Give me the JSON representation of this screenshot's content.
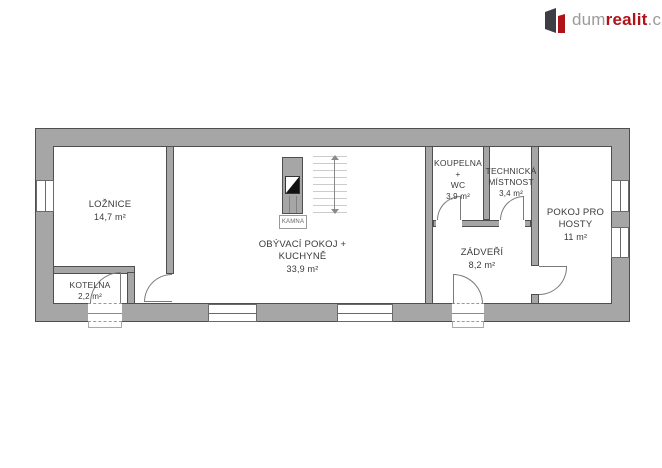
{
  "logo": {
    "prefix": "dum",
    "highlight": "realit",
    "suffix": ".cz"
  },
  "rooms": {
    "loznice": {
      "name": "LOŽNICE",
      "area": "14,7 m²"
    },
    "kotelna": {
      "name": "KOTELNA",
      "area": "2,2 m²"
    },
    "obyvaci": {
      "line1": "OBÝVACÍ POKOJ +",
      "line2": "KUCHYNĚ",
      "area": "33,9 m²"
    },
    "koupelna": {
      "line1": "KOUPELNA",
      "line2": "+",
      "line3": "WC",
      "area": "3,9 m²"
    },
    "technicka": {
      "line1": "TECHNICKÁ",
      "line2": "MÍSTNOST",
      "area": "3,4 m²"
    },
    "zadveri": {
      "name": "ZÁDVEŘÍ",
      "area": "8,2 m²"
    },
    "pokoj_pro_hosty": {
      "line1": "POKOJ PRO",
      "line2": "HOSTY",
      "area": "11 m²"
    }
  },
  "stove_label": "KAMNA",
  "colors": {
    "wall_fill": "#a6a6a6",
    "wall_outline": "#4f4f4f",
    "logo_red": "#b01219",
    "logo_gray": "#9b9b9b"
  }
}
